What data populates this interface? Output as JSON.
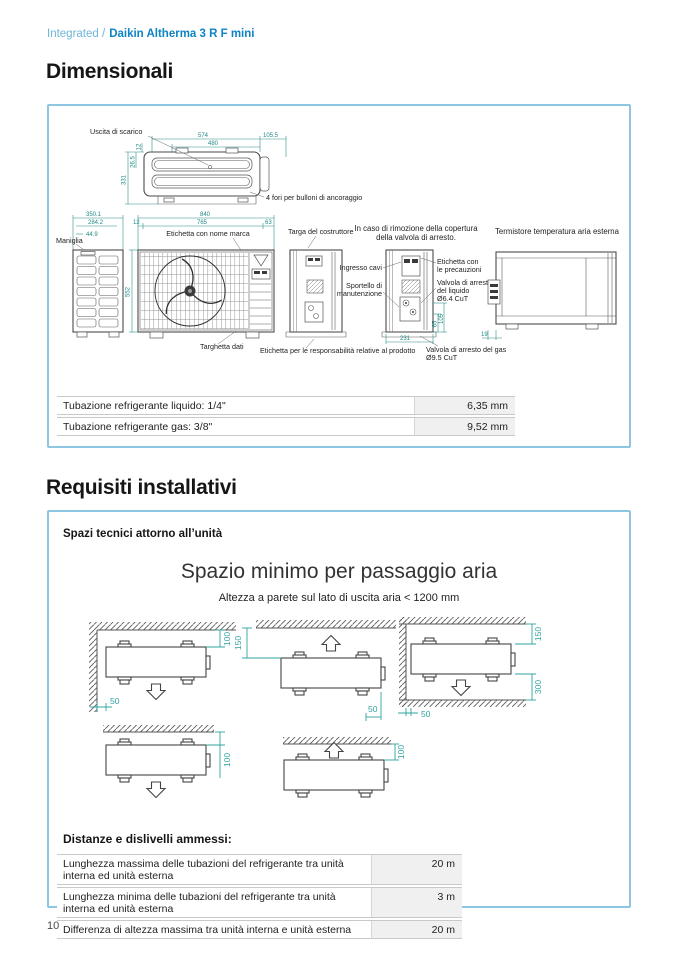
{
  "colors": {
    "brand_blue": "#0d84c4",
    "breadcrumb_light_blue": "#6cb6d9",
    "panel_border_blue": "#8cc6e2",
    "dimension_teal": "#2fa3a0",
    "table_value_bg": "#f0f0f0"
  },
  "header": {
    "breadcrumb_section": "Integrated /",
    "breadcrumb_product": "Daikin Altherma 3 R F mini"
  },
  "dimensionali": {
    "title": "Dimensionali",
    "top_view": {
      "label_uscita": "Uscita di scarico",
      "label_fori": "4 fori per bulloni di ancoraggio",
      "dim_574": "574",
      "dim_1055": "105.5",
      "dim_480": "480",
      "dim_12": "12",
      "dim_265": "26.5",
      "dim_331": "331"
    },
    "front_row": {
      "label_maniglia": "Maniglia",
      "label_etichetta_marca": "Etichetta con nome marca",
      "label_targhetta": "Targhetta dati",
      "label_targa": "Targa del costruttore",
      "label_resp": "Etichetta per le responsabilità relative al prodotto",
      "dim_3501": "350.1",
      "dim_2842": "284.2",
      "dim_449": "44.9",
      "dim_840": "840",
      "dim_12": "12",
      "dim_765": "765",
      "dim_63": "63",
      "dim_552": "552"
    },
    "valve_view": {
      "title_line1": "In caso di rimozione della copertura",
      "title_line2": "della valvola di arresto.",
      "label_ingresso": "Ingresso cavi",
      "label_sportello_1": "Sportello di",
      "label_sportello_2": "manutenzione",
      "label_precauzioni_1": "Etichetta con",
      "label_precauzioni_2": "le precauzioni",
      "label_liquido_1": "Valvola di arresto",
      "label_liquido_2": "del liquido",
      "label_liquido_3": "Ø6.4 CuT",
      "label_gas_1": "Valvola di arresto del gas",
      "label_gas_2": "Ø9.5 CuT",
      "dim_231": "231",
      "dim_65": "65",
      "dim_105": "105"
    },
    "thermistor_view": {
      "title": "Termistore temperatura aria esterna",
      "dim_19": "19"
    },
    "pipe_table": {
      "rows": [
        {
          "label": "Tubazione refrigerante liquido: 1/4\"",
          "value": "6,35 mm"
        },
        {
          "label": "Tubazione refrigerante gas: 3/8\"",
          "value": "9,52 mm"
        }
      ]
    }
  },
  "requisiti": {
    "title": "Requisiti installativi",
    "section_label": "Spazi tecnici attorno all’unità",
    "diagram_title": "Spazio minimo per passaggio aria",
    "diagram_subtitle": "Altezza a parete sul lato di uscita aria < 1200 mm",
    "clearances": {
      "top_100": "100",
      "top_150": "150",
      "side_50": "50",
      "bottom_300": "300"
    },
    "distances_label": "Distanze e dislivelli ammessi:",
    "distances_table": {
      "rows": [
        {
          "label": "Lunghezza massima delle tubazioni del refrigerante tra unità interna ed unità esterna",
          "value": "20 m"
        },
        {
          "label": "Lunghezza minima delle tubazioni del refrigerante tra unità interna ed unità esterna",
          "value": "3 m"
        },
        {
          "label": "Differenza di altezza massima tra unità interna e unità esterna",
          "value": "20 m"
        }
      ]
    }
  },
  "footer": {
    "page_number": "10"
  }
}
